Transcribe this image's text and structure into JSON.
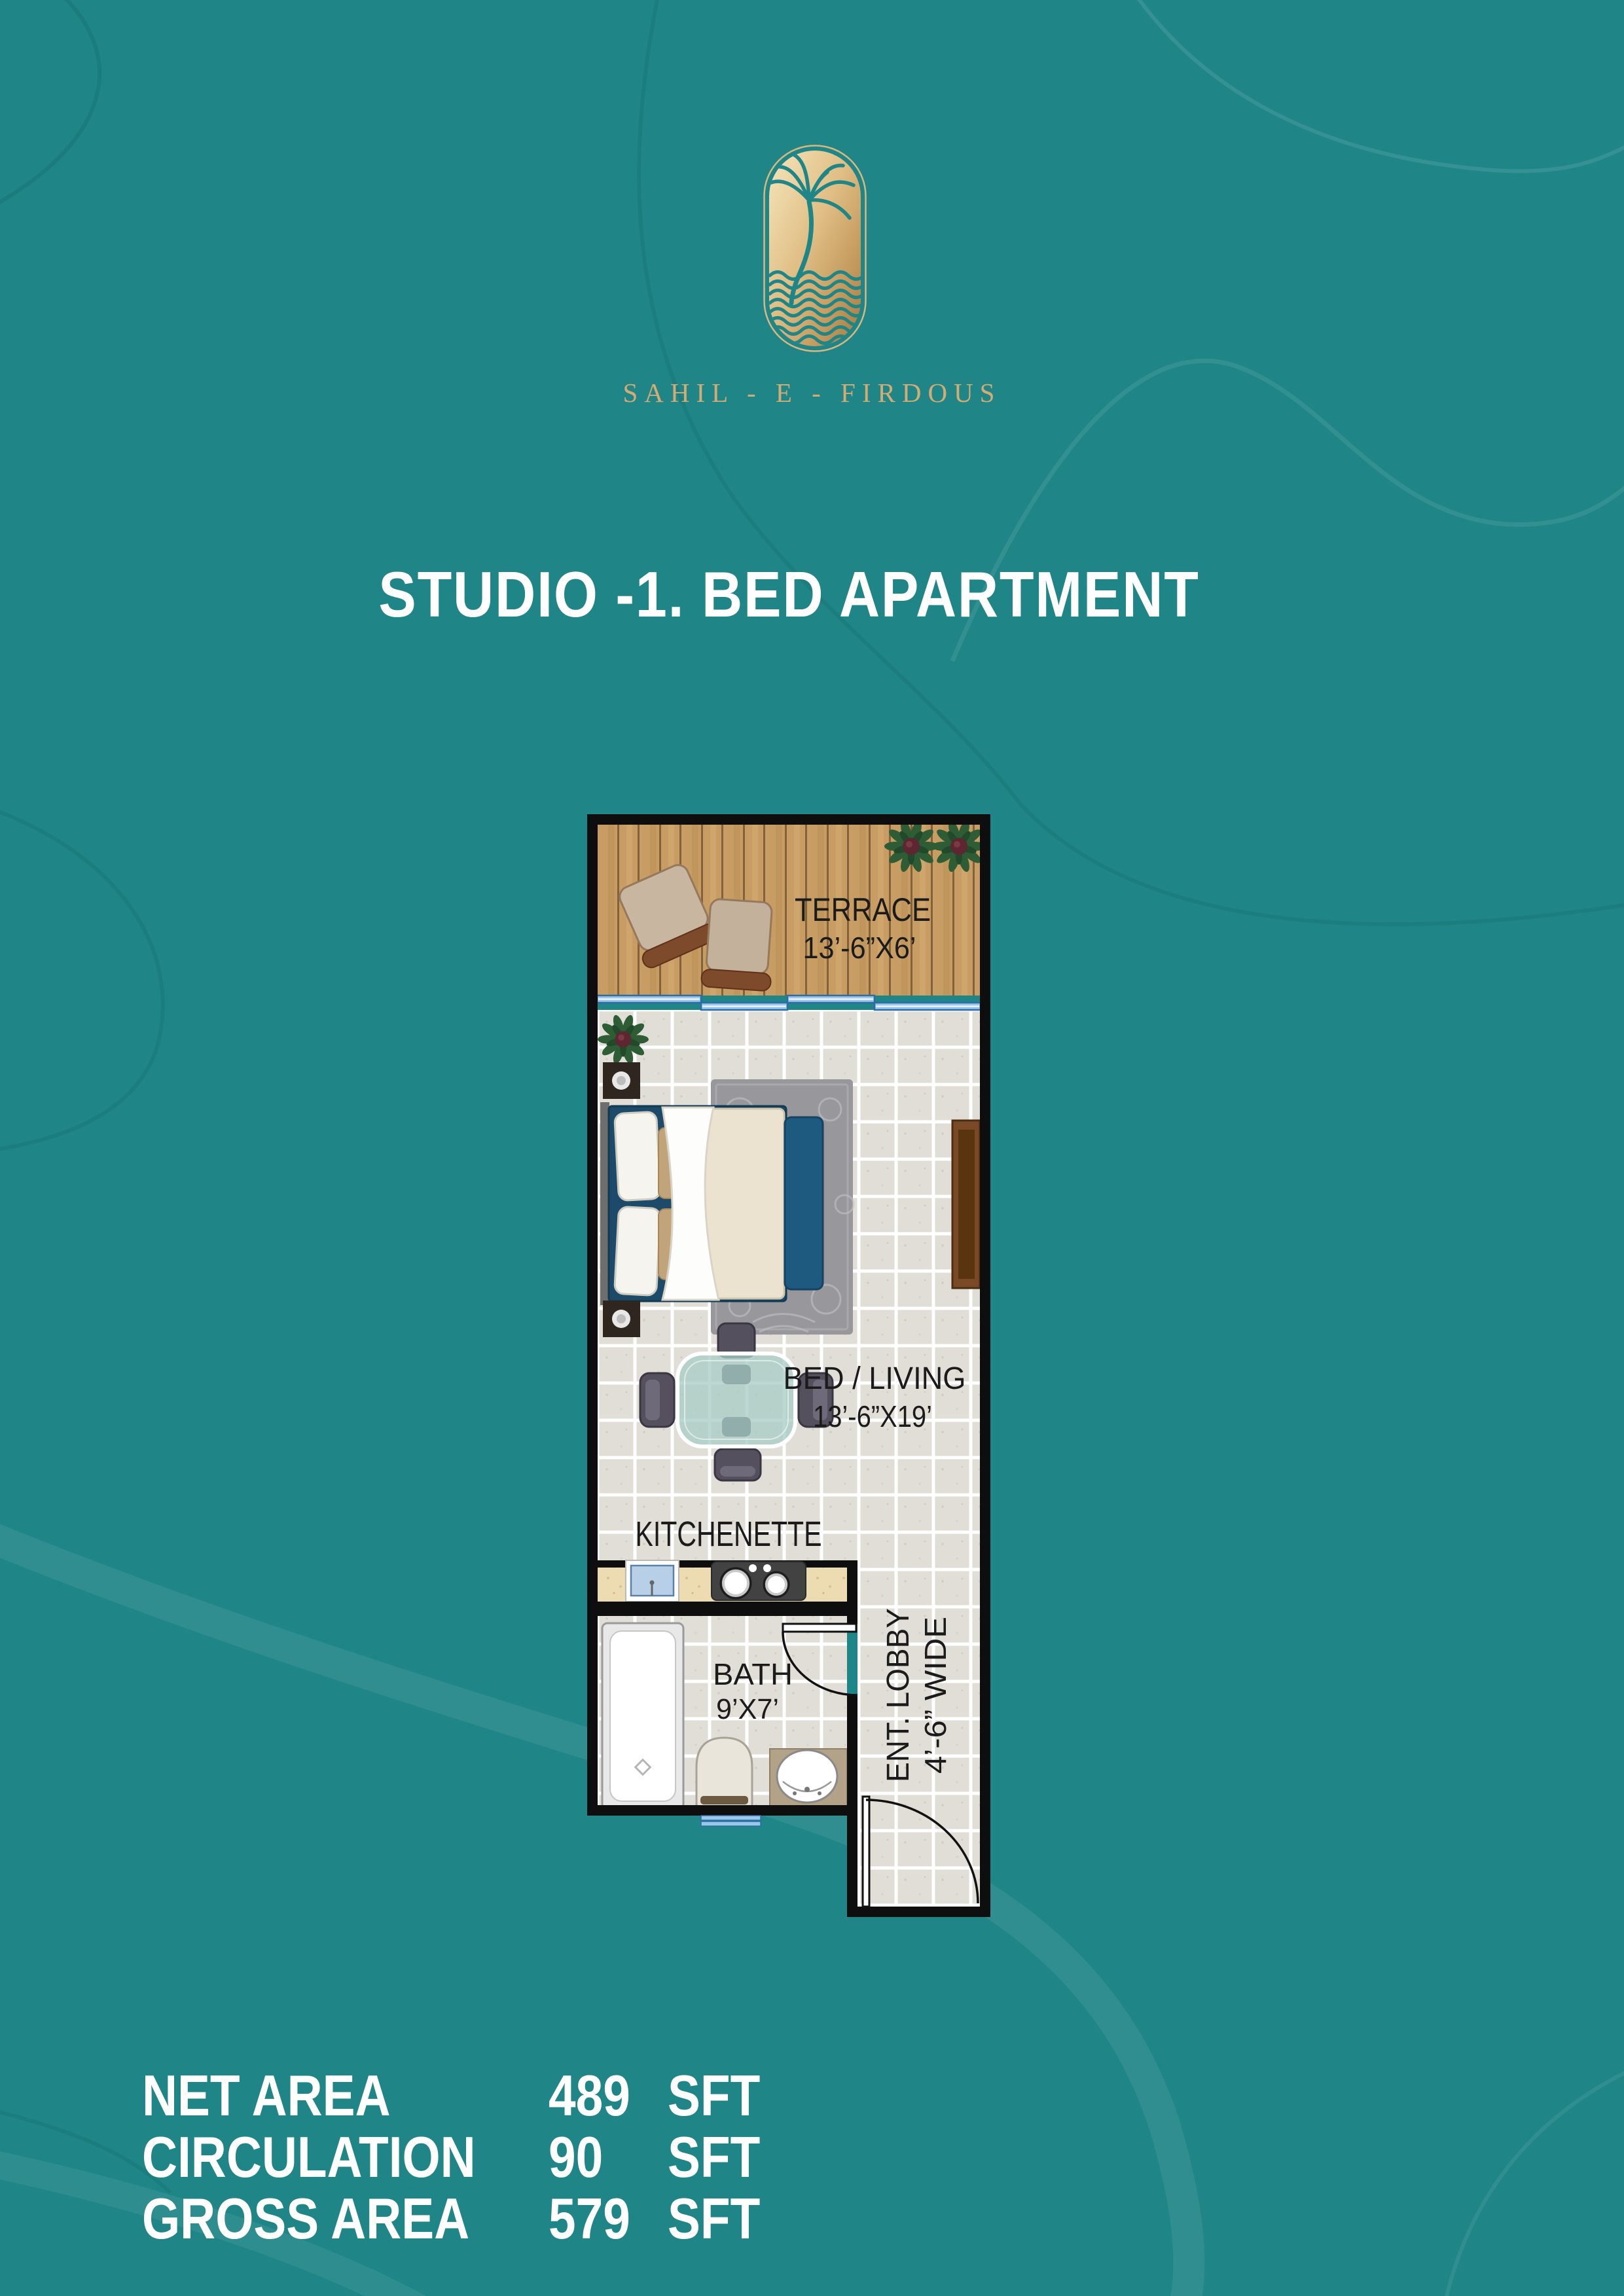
{
  "brand": {
    "name": "SAHIL - E - FIRDOUS"
  },
  "title": "STUDIO -1. BED APARTMENT",
  "plan": {
    "rooms": {
      "terrace": {
        "label": "TERRACE",
        "dim": "13’-6”X6’"
      },
      "bed_living": {
        "label": "BED / LIVING",
        "dim": "13’-6”X19’"
      },
      "kitchenette": {
        "label": "KITCHENETTE"
      },
      "bath": {
        "label": "BATH",
        "dim": "9’X7’"
      },
      "lobby": {
        "label": "ENT. LOBBY",
        "dim": "4’-6” WIDE"
      }
    }
  },
  "areas": {
    "rows": [
      {
        "label": "NET AREA",
        "value": "489",
        "unit": "SFT"
      },
      {
        "label": "CIRCULATION",
        "value": "90",
        "unit": "SFT"
      },
      {
        "label": "GROSS AREA",
        "value": "579",
        "unit": "SFT"
      }
    ]
  },
  "colors": {
    "background": "#1f8587",
    "gold": "#c9a36a",
    "title_text": "#ffffff",
    "plan_wall": "#0e0e0e",
    "window_blue": "#9cc7ec"
  }
}
